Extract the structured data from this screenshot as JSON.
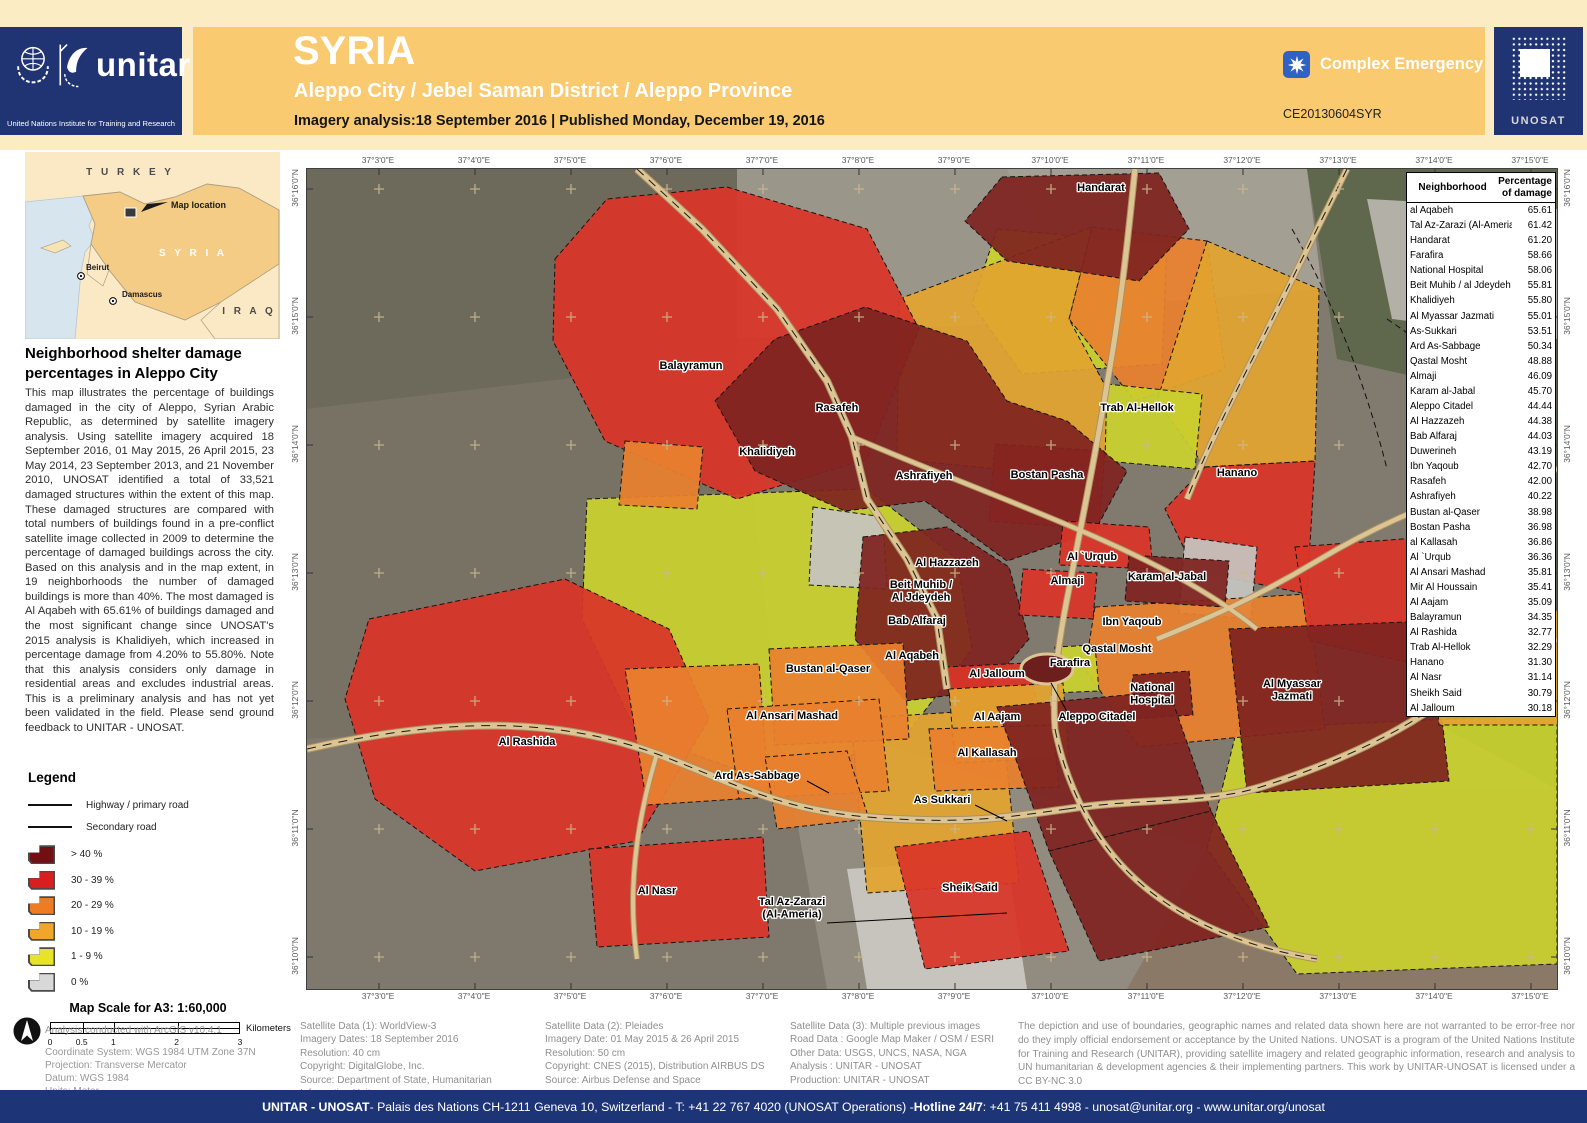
{
  "colors": {
    "m": "#7f2320",
    "r": "#d93528",
    "o": "#e8802e",
    "a": "#e2a42f",
    "y": "#c9d12e",
    "g": "#c6c4c0"
  },
  "header": {
    "title": "SYRIA",
    "subtitle": "Aleppo City / Jebel Saman District / Aleppo Province",
    "analysis_line": "Imagery analysis:18 September 2016 | Published Monday, December 19, 2016",
    "badge": "Complex Emergency",
    "ce_number": "CE20130604SYR",
    "unitar_wordmark": "unitar",
    "unitar_caption": "United Nations Institute for Training and Research",
    "unosat_logo": "UNOSAT"
  },
  "inset": {
    "turkey": "T U R K E Y",
    "syria": "S Y R I A",
    "iraq": "I R A Q",
    "map_location": "Map location",
    "beirut": "Beirut",
    "damascus": "Damascus"
  },
  "sidebar": {
    "heading": "Neighborhood shelter damage percentages in Aleppo City",
    "paragraph": "This map illustrates the percentage of buildings damaged in the city of Aleppo, Syrian Arabic Republic, as determined by satellite imagery analysis. Using satellite imagery acquired 18 September 2016, 01 May 2015, 26 April 2015, 23 May 2014, 23 September 2013, and 21 November 2010, UNOSAT identified a total of 33,521 damaged structures within the extent of this map. These damaged structures are compared with total numbers of buildings found in a pre-conflict satellite image collected in 2009 to determine the percentage of damaged buildings across the city. Based on this analysis and in the map extent, in 19 neighborhoods the number of damaged buildings is more than 40%. The most damaged is Al Aqabeh with 65.61% of buildings damaged and the most significant change since UNOSAT's 2015 analysis is Khalidiyeh, which increased in percentage damage from 4.20% to 55.80%. Note that this analysis considers only damage in residential areas and excludes industrial areas. This is a preliminary analysis and has not yet been validated in the field. Please send ground feedback to UNITAR - UNOSAT.",
    "legend_title": "Legend",
    "legend_roads": [
      {
        "label": "Highway / primary road"
      },
      {
        "label": "Secondary road"
      }
    ],
    "legend_classes": [
      {
        "label": "> 40 %",
        "color": "#720f13"
      },
      {
        "label": "30 - 39 %",
        "color": "#d91e20"
      },
      {
        "label": "20 - 29 %",
        "color": "#ee7c22"
      },
      {
        "label": "10 - 19 %",
        "color": "#f0a52b"
      },
      {
        "label": "1 - 9 %",
        "color": "#e6e32a"
      },
      {
        "label": "0 %",
        "color": "#d8d8d8"
      }
    ],
    "scale_title": "Map Scale for A3: 1:60,000",
    "scale_ticks": [
      "0",
      "0.5",
      "1",
      "2",
      "3"
    ],
    "scale_values": [
      0,
      0.5,
      1,
      2,
      3
    ],
    "scale_unit": "Kilometers",
    "analysis_note": "Analysis conducted with ArcGIS v10.4.1",
    "coord_lines": [
      "Coordinate System: WGS 1984 UTM Zone 37N",
      "Projection: Transverse Mercator",
      "Datum: WGS 1984",
      "Units: Meter"
    ]
  },
  "map": {
    "lon_labels": [
      "37°3'0\"E",
      "37°4'0\"E",
      "37°5'0\"E",
      "37°6'0\"E",
      "37°7'0\"E",
      "37°8'0\"E",
      "37°9'0\"E",
      "37°10'0\"E",
      "37°11'0\"E",
      "37°12'0\"E",
      "37°13'0\"E",
      "37°14'0\"E",
      "37°15'0\"E"
    ],
    "lat_labels": [
      "36°16'0\"N",
      "36°15'0\"N",
      "36°14'0\"N",
      "36°13'0\"N",
      "36°12'0\"N",
      "36°11'0\"N",
      "36°10'0\"N"
    ],
    "base_color": "#807b6e",
    "patches": [
      {
        "c": "#6e6a5b",
        "p": "0,0 430,0 430,190 0,240"
      },
      {
        "c": "#9a968a",
        "p": "430,0 780,0 770,150 430,170"
      },
      {
        "c": "#a49f93",
        "p": "700,0 1000,0 1015,120 760,140"
      },
      {
        "c": "#5f684c",
        "p": "1000,0 1250,0 1250,240 1030,190"
      },
      {
        "c": "#b3b0a8",
        "p": "1060,30 1250,40 1250,170 1085,150"
      },
      {
        "c": "#56614b",
        "p": "1130,240 1250,240 1250,620 1140,560"
      },
      {
        "c": "#8b7968",
        "p": "900,620 1250,620 1250,820 820,820"
      },
      {
        "c": "#777264",
        "p": "0,240 430,190 470,540 0,570"
      },
      {
        "c": "#7e796c",
        "p": "0,570 470,540 520,820 0,820"
      },
      {
        "c": "#918c7f",
        "p": "470,540 900,680 820,820 520,820"
      },
      {
        "c": "#c7c4be",
        "p": "540,700 700,690 720,820 560,820"
      }
    ],
    "regions": [
      {
        "c": "y",
        "p": "930,560 1250,545 1250,795 990,805 900,680"
      },
      {
        "c": "y",
        "p": "280,330 560,320 650,390 665,480 600,565 470,615 330,565 275,450"
      },
      {
        "c": "y",
        "p": "690,60 860,75 855,195 715,205 665,135"
      },
      {
        "c": "o",
        "p": "785,58 900,72 918,200 828,232 762,150"
      },
      {
        "c": "a",
        "p": "900,72 1012,120 1008,292 898,298 850,232"
      },
      {
        "c": "a",
        "p": "592,130 785,58 762,150 800,220 800,292 690,300 590,290"
      },
      {
        "c": "r",
        "p": "898,298 1008,292 1000,425 888,402 858,340"
      },
      {
        "c": "r",
        "p": "248,90 300,30 420,18 560,60 612,160 560,290 430,330 298,272 246,172"
      },
      {
        "c": "m",
        "p": "695,8 852,4 882,60 832,112 700,92 658,52"
      },
      {
        "c": "y",
        "p": "800,215 895,225 888,300 798,292"
      },
      {
        "c": "r",
        "p": "688,275 798,282 792,360 682,352"
      },
      {
        "c": "m",
        "p": "408,232 468,170 558,138 660,172 700,232 760,252 820,302 788,362 700,392 618,332 538,342 448,302"
      },
      {
        "c": "o",
        "p": "318,272 396,278 390,340 312,336"
      },
      {
        "c": "a",
        "p": "544,550 694,540 712,714 560,724"
      },
      {
        "c": "r",
        "p": "62,450 258,410 362,460 402,550 330,672 168,702 68,630 38,530"
      },
      {
        "c": "o",
        "p": "318,500 452,495 462,628 340,636"
      },
      {
        "c": "g",
        "p": "506,338 576,348 580,420 502,416"
      },
      {
        "c": "g",
        "p": "878,368 950,378 944,450 872,444"
      },
      {
        "c": "o",
        "p": "788,438 1000,425 1018,560 832,578 778,500"
      },
      {
        "c": "m",
        "p": "556,368 640,358 702,398 722,470 678,522 598,532 548,470"
      },
      {
        "c": "r",
        "p": "756,352 842,358 846,400 752,396"
      },
      {
        "c": "m",
        "p": "822,386 922,392 918,438 818,432"
      },
      {
        "c": "r",
        "p": "716,400 790,404 786,450 712,446"
      },
      {
        "c": "y",
        "p": "748,478 788,476 792,522 746,524"
      },
      {
        "c": "m",
        "p": "826,506 882,502 886,546 822,550"
      },
      {
        "c": "r",
        "p": "638,498 720,494 736,556 648,562"
      },
      {
        "c": "o",
        "p": "462,480 596,474 602,570 468,576"
      },
      {
        "c": "o",
        "p": "420,540 572,530 582,622 432,630"
      },
      {
        "c": "a",
        "p": "642,520 756,514 762,588 648,594"
      },
      {
        "c": "o",
        "p": "622,560 746,556 752,618 628,622"
      },
      {
        "c": "o",
        "p": "458,588 540,582 562,650 470,660"
      },
      {
        "c": "m",
        "p": "690,538 862,522 904,642 742,682"
      },
      {
        "c": "m",
        "p": "742,682 904,642 962,758 792,792"
      },
      {
        "c": "r",
        "p": "988,378 1122,368 1142,502 1002,472"
      },
      {
        "c": "m",
        "p": "922,460 1124,452 1142,612 940,624"
      },
      {
        "c": "a",
        "p": "1124,452 1252,442 1252,556 1132,556"
      },
      {
        "c": "r",
        "p": "588,678 722,662 762,782 618,800"
      },
      {
        "c": "r",
        "p": "282,680 456,668 462,768 290,778"
      }
    ],
    "citadel": {
      "cx": 740,
      "cy": 500,
      "rx": 26,
      "ry": 15
    },
    "roads": [
      {
        "d": "M330,0 L395,60 L470,140 L520,212 L545,268 L560,330 L600,390 L630,450 L640,520",
        "w": 6,
        "hw": true
      },
      {
        "d": "M0,580 C140,548 250,548 350,585 C430,615 470,640 560,648 C660,656 700,648 760,640",
        "w": 6,
        "hw": true
      },
      {
        "d": "M760,640 C840,628 900,636 960,616 C1040,590 1100,560 1145,525 L1250,470",
        "w": 6,
        "hw": true
      },
      {
        "d": "M828,0 C820,80 812,150 800,215 C788,290 775,350 762,420 C750,480 745,520 748,560",
        "w": 5,
        "hw": false
      },
      {
        "d": "M1040,0 C1005,70 975,130 948,185 C920,240 900,280 880,330",
        "w": 5,
        "hw": true
      },
      {
        "d": "M1250,300 C1150,320 1080,350 1010,392 C950,428 900,450 850,470",
        "w": 4.5,
        "hw": false
      },
      {
        "d": "M545,268 C620,300 700,330 770,360 C840,390 900,420 950,460",
        "w": 4,
        "hw": false
      },
      {
        "d": "M748,560 C760,620 790,680 840,720 C890,760 950,780 1010,790",
        "w": 5,
        "hw": true
      },
      {
        "d": "M350,585 C330,650 320,720 330,790",
        "w": 4,
        "hw": false
      }
    ],
    "boundaries": [
      "M985,60 C1030,140 1060,220 1080,300",
      "M1080,150 C1140,190 1190,240 1240,300"
    ],
    "labels": [
      {
        "lines": [
          "Handarat"
        ],
        "x": 794,
        "y": 22
      },
      {
        "lines": [
          "Balayramun"
        ],
        "x": 384,
        "y": 200
      },
      {
        "lines": [
          "Rasafeh"
        ],
        "x": 530,
        "y": 242
      },
      {
        "lines": [
          "Trab Al-Hellok"
        ],
        "x": 830,
        "y": 242
      },
      {
        "lines": [
          "Khalidiyeh"
        ],
        "x": 460,
        "y": 286
      },
      {
        "lines": [
          "Ashrafiyeh"
        ],
        "x": 617,
        "y": 310
      },
      {
        "lines": [
          "Bostan Pasha"
        ],
        "x": 740,
        "y": 309
      },
      {
        "lines": [
          "Hanano"
        ],
        "x": 930,
        "y": 307
      },
      {
        "lines": [
          "Al Hazzazeh"
        ],
        "x": 640,
        "y": 397
      },
      {
        "lines": [
          "Beit Muhib /",
          "Al Jdeydeh"
        ],
        "x": 614,
        "y": 419
      },
      {
        "lines": [
          "Al `Urqub"
        ],
        "x": 785,
        "y": 391
      },
      {
        "lines": [
          "Karam al-Jabal"
        ],
        "x": 860,
        "y": 411
      },
      {
        "lines": [
          "Almaji"
        ],
        "x": 760,
        "y": 415
      },
      {
        "lines": [
          "Bab Alfaraj"
        ],
        "x": 610,
        "y": 455
      },
      {
        "lines": [
          "Ibn Yaqoub"
        ],
        "x": 825,
        "y": 456
      },
      {
        "lines": [
          "Qastal Mosht"
        ],
        "x": 810,
        "y": 483
      },
      {
        "lines": [
          "Al Aqabeh"
        ],
        "x": 605,
        "y": 490
      },
      {
        "lines": [
          "Farafira"
        ],
        "x": 763,
        "y": 497
      },
      {
        "lines": [
          "Bustan al-Qaser"
        ],
        "x": 521,
        "y": 503
      },
      {
        "lines": [
          "Al Jalloum"
        ],
        "x": 690,
        "y": 508
      },
      {
        "lines": [
          "National",
          "Hospital"
        ],
        "x": 845,
        "y": 522
      },
      {
        "lines": [
          "Al Myassar",
          "Jazmati"
        ],
        "x": 985,
        "y": 518
      },
      {
        "lines": [
          "Al Ansari Mashad"
        ],
        "x": 485,
        "y": 550
      },
      {
        "lines": [
          "Al Aajam"
        ],
        "x": 690,
        "y": 551
      },
      {
        "lines": [
          "Aleppo Citadel"
        ],
        "x": 790,
        "y": 551,
        "leader": [
          762,
          546,
          744,
          514
        ]
      },
      {
        "lines": [
          "Al Kallasah"
        ],
        "x": 680,
        "y": 587
      },
      {
        "lines": [
          "Al Rashida"
        ],
        "x": 220,
        "y": 576
      },
      {
        "lines": [
          "Ard As-Sabbage"
        ],
        "x": 450,
        "y": 610,
        "leader": [
          500,
          612,
          522,
          624
        ]
      },
      {
        "lines": [
          "As Sukkari"
        ],
        "x": 635,
        "y": 634,
        "leader": [
          668,
          636,
          700,
          652
        ]
      },
      {
        "lines": [
          "Al Nasr"
        ],
        "x": 350,
        "y": 725
      },
      {
        "lines": [
          "Tal Az-Zarazi",
          "(Al-Ameria)"
        ],
        "x": 485,
        "y": 736,
        "leader": [
          520,
          754,
          700,
          744
        ]
      },
      {
        "lines": [
          "Sheik Said"
        ],
        "x": 663,
        "y": 722
      }
    ],
    "table": {
      "col1": "Neighborhood",
      "col2": "Percentage of damage",
      "rows": [
        [
          "al Aqabeh",
          "65.61"
        ],
        [
          "Tal Az-Zarazi (Al-Ameria)",
          "61.42"
        ],
        [
          "Handarat",
          "61.20"
        ],
        [
          "Farafira",
          "58.66"
        ],
        [
          "National Hospital",
          "58.06"
        ],
        [
          "Beit Muhib / al Jdeydeh",
          "55.81"
        ],
        [
          "Khalidiyeh",
          "55.80"
        ],
        [
          "Al Myassar Jazmati",
          "55.01"
        ],
        [
          "As-Sukkari",
          "53.51"
        ],
        [
          "Ard As-Sabbage",
          "50.34"
        ],
        [
          "Qastal Mosht",
          "48.88"
        ],
        [
          "Almaji",
          "46.09"
        ],
        [
          "Karam al-Jabal",
          "45.70"
        ],
        [
          "Aleppo Citadel",
          "44.44"
        ],
        [
          "Al Hazzazeh",
          "44.38"
        ],
        [
          "Bab Alfaraj",
          "44.03"
        ],
        [
          "Duwerineh",
          "43.19"
        ],
        [
          "Ibn Yaqoub",
          "42.70"
        ],
        [
          "Rasafeh",
          "42.00"
        ],
        [
          "Ashrafiyeh",
          "40.22"
        ],
        [
          "Bustan al-Qaser",
          "38.98"
        ],
        [
          "Bostan Pasha",
          "36.98"
        ],
        [
          "al Kallasah",
          "36.86"
        ],
        [
          "Al `Urqub",
          "36.36"
        ],
        [
          "Al Ansari Mashad",
          "35.81"
        ],
        [
          "Mir Al Houssain",
          "35.41"
        ],
        [
          "Al Aajam",
          "35.09"
        ],
        [
          "Balayramun",
          "34.35"
        ],
        [
          "Al Rashida",
          "32.77"
        ],
        [
          "Trab Al-Hellok",
          "32.29"
        ],
        [
          "Hanano",
          "31.30"
        ],
        [
          "Al Nasr",
          "31.14"
        ],
        [
          "Sheikh Said",
          "30.79"
        ],
        [
          "Al Jalloum",
          "30.18"
        ]
      ]
    }
  },
  "footnotes": {
    "sat1": [
      "Satellite Data (1): WorldView-3",
      "Imagery Dates: 18 September 2016",
      "Resolution: 40 cm",
      "Copyright: DigitalGlobe, Inc.",
      "Source: Department of State, Humanitarian Information Unit,",
      "NextView License"
    ],
    "sat2": [
      "Satellite Data (2): Pleiades",
      "Imagery Date: 01 May 2015 & 26 April 2015",
      "Resolution: 50 cm",
      "Copyright: CNES (2015), Distribution AIRBUS DS",
      "Source: Airbus Defense and Space"
    ],
    "sat3": [
      "Satellite Data (3): Multiple previous images",
      "Road Data : Google Map Maker / OSM / ESRI",
      "Other Data: USGS, UNCS, NASA, NGA",
      "Analysis : UNITAR - UNOSAT",
      "Production: UNITAR - UNOSAT"
    ],
    "disclaimer": "The depiction and use of boundaries, geographic names and related data shown here are not warranted to be error-free nor do they imply official endorsement or acceptance by the United Nations. UNOSAT is a program of the United Nations Institute for Training and Research (UNITAR), providing satellite imagery and related geographic information, research and analysis to UN humanitarian & development agencies & their implementing partners. This work by UNITAR-UNOSAT is licensed under a CC BY-NC 3.0"
  },
  "footer": {
    "segments": [
      {
        "text": "UNITAR - UNOSAT",
        "bold": true
      },
      {
        "text": " - Palais des Nations CH-1211 Geneva 10, Switzerland - T: +41 22 767 4020 (UNOSAT Operations) - ",
        "bold": false
      },
      {
        "text": "Hotline 24/7",
        "bold": true
      },
      {
        "text": ": +41 75 411 4998 - unosat@unitar.org - www.unitar.org/unosat",
        "bold": false
      }
    ]
  }
}
